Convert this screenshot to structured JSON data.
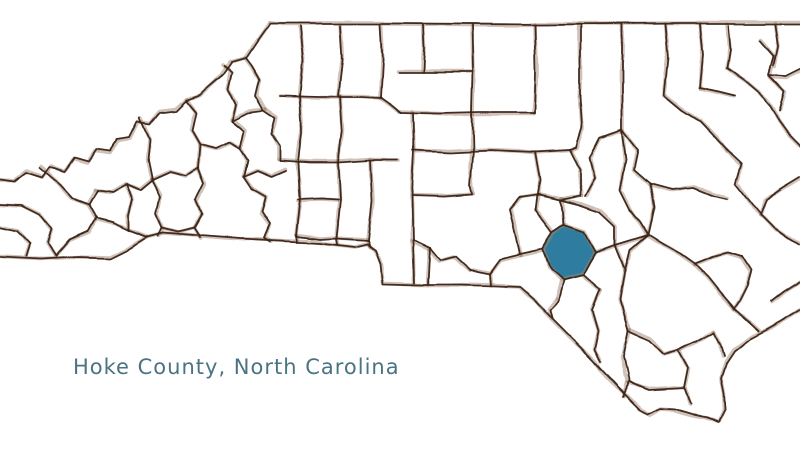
{
  "caption": {
    "label": "Hoke County, North Carolina"
  },
  "map": {
    "state": "North Carolina",
    "highlighted_county": "Hoke",
    "colors": {
      "background": "#ffffff",
      "border_ink": "#3a2418",
      "border_halo": "#a18570",
      "highlight_fill": "#2e7da0",
      "caption_text": "#4a7383"
    }
  }
}
